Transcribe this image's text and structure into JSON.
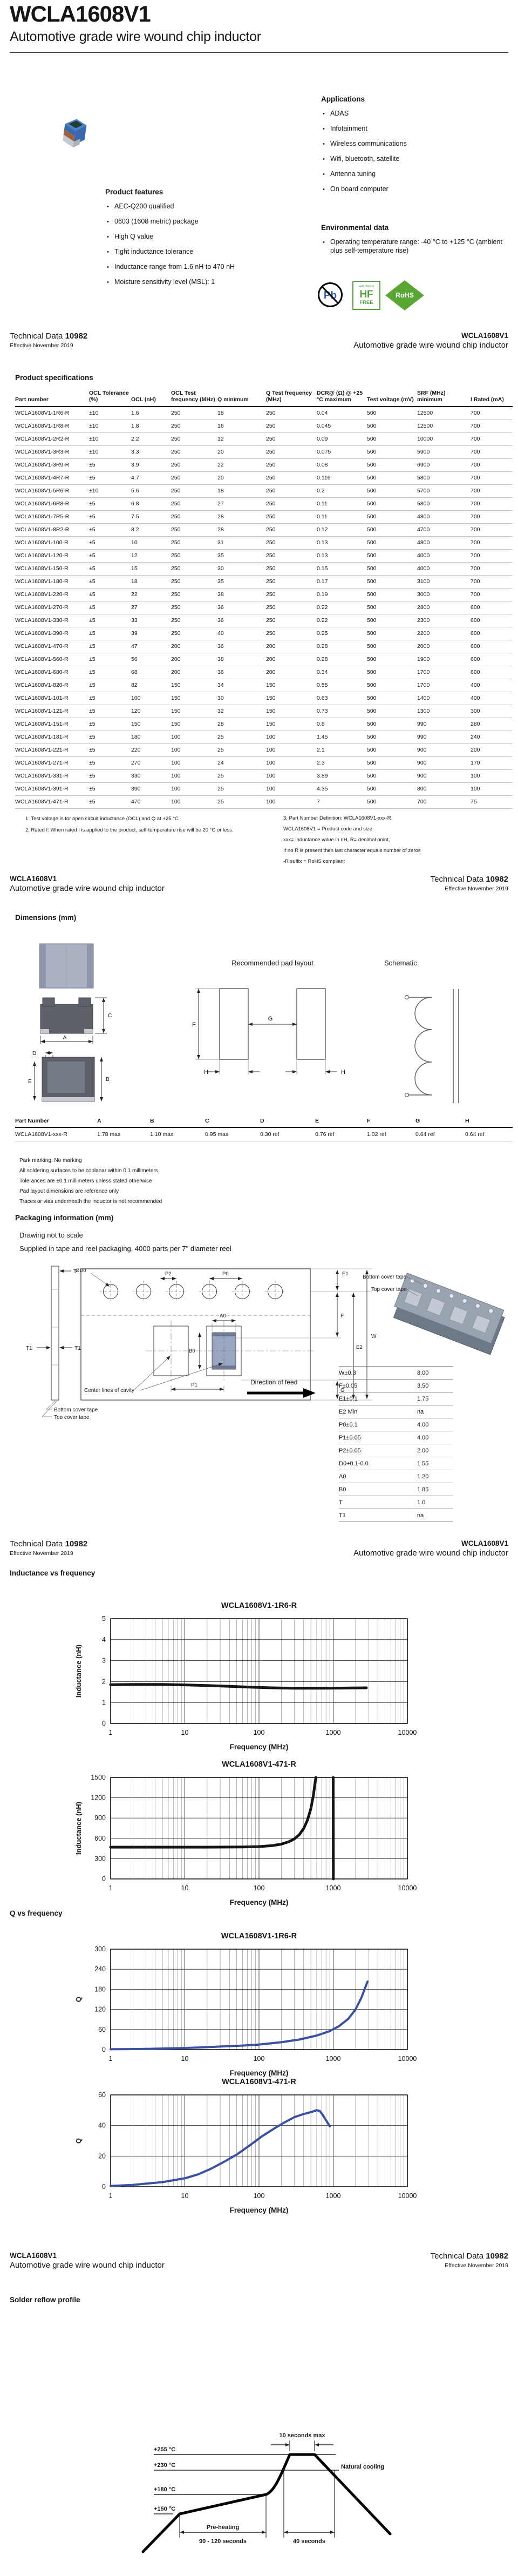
{
  "doc": {
    "title": "WCLA1608V1",
    "subtitle": "Automotive grade wire wound chip inductor",
    "technical_data_label": "Technical Data",
    "technical_data_number": "10982",
    "effective": "Effective November 2019"
  },
  "applications": {
    "heading": "Applications",
    "items": [
      "ADAS",
      "Infotainment",
      "Wireless communications",
      "Wifi, bluetooth, satellite",
      "Antenna tuning",
      "On board computer"
    ]
  },
  "features": {
    "heading": "Product features",
    "items": [
      "AEC-Q200 qualified",
      "0603 (1608 metric) package",
      "High Q value",
      "Tight inductance tolerance",
      "Inductance range from 1.6 nH to 470 nH",
      "Moisture sensitivity level (MSL): 1"
    ]
  },
  "environmental": {
    "heading": "Environmental data",
    "items": [
      "Operating temperature range: -40 °C to +125 °C (ambient plus self-temperature rise)"
    ]
  },
  "logos": {
    "pb": "Pb",
    "hf_line1": "HALOGEN",
    "hf_line2": "HF",
    "hf_line3": "FREE",
    "rohs": "RoHS"
  },
  "specs": {
    "heading": "Product specifications",
    "columns": [
      "Part number",
      "OCL Tolerance (%)",
      "OCL (nH)",
      "OCL Test frequency (MHz)",
      "Q minimum",
      "Q Test frequency (MHz)",
      "DCR@ (Ω) @ +25 °C maximum",
      "Test voltage (mV)",
      "SRF (MHz) minimum",
      "I Rated (mA)"
    ],
    "rows": [
      [
        "WCLA1608V1-1R6-R",
        "±10",
        "1.6",
        "250",
        "18",
        "250",
        "0.04",
        "500",
        "12500",
        "700"
      ],
      [
        "WCLA1608V1-1R8-R",
        "±10",
        "1.8",
        "250",
        "16",
        "250",
        "0.045",
        "500",
        "12500",
        "700"
      ],
      [
        "WCLA1608V1-2R2-R",
        "±10",
        "2.2",
        "250",
        "12",
        "250",
        "0.09",
        "500",
        "10000",
        "700"
      ],
      [
        "WCLA1608V1-3R3-R",
        "±10",
        "3.3",
        "250",
        "20",
        "250",
        "0.075",
        "500",
        "5900",
        "700"
      ],
      [
        "WCLA1608V1-3R9-R",
        "±5",
        "3.9",
        "250",
        "22",
        "250",
        "0.08",
        "500",
        "6900",
        "700"
      ],
      [
        "WCLA1608V1-4R7-R",
        "±5",
        "4.7",
        "250",
        "20",
        "250",
        "0.116",
        "500",
        "5800",
        "700"
      ],
      [
        "WCLA1608V1-5R6-R",
        "±10",
        "5.6",
        "250",
        "18",
        "250",
        "0.2",
        "500",
        "5700",
        "700"
      ],
      [
        "WCLA1608V1-6R8-R",
        "±5",
        "6.8",
        "250",
        "27",
        "250",
        "0.11",
        "500",
        "5800",
        "700"
      ],
      [
        "WCLA1608V1-7R5-R",
        "±5",
        "7.5",
        "250",
        "28",
        "250",
        "0.11",
        "500",
        "4800",
        "700"
      ],
      [
        "WCLA1608V1-8R2-R",
        "±5",
        "8.2",
        "250",
        "28",
        "250",
        "0.12",
        "500",
        "4700",
        "700"
      ],
      [
        "WCLA1608V1-100-R",
        "±5",
        "10",
        "250",
        "31",
        "250",
        "0.13",
        "500",
        "4800",
        "700"
      ],
      [
        "WCLA1608V1-120-R",
        "±5",
        "12",
        "250",
        "35",
        "250",
        "0.13",
        "500",
        "4000",
        "700"
      ],
      [
        "WCLA1608V1-150-R",
        "±5",
        "15",
        "250",
        "30",
        "250",
        "0.15",
        "500",
        "4000",
        "700"
      ],
      [
        "WCLA1608V1-180-R",
        "±5",
        "18",
        "250",
        "35",
        "250",
        "0.17",
        "500",
        "3100",
        "700"
      ],
      [
        "WCLA1608V1-220-R",
        "±5",
        "22",
        "250",
        "38",
        "250",
        "0.19",
        "500",
        "3000",
        "700"
      ],
      [
        "WCLA1608V1-270-R",
        "±5",
        "27",
        "250",
        "36",
        "250",
        "0.22",
        "500",
        "2800",
        "600"
      ],
      [
        "WCLA1608V1-330-R",
        "±5",
        "33",
        "250",
        "36",
        "250",
        "0.22",
        "500",
        "2300",
        "600"
      ],
      [
        "WCLA1608V1-390-R",
        "±5",
        "39",
        "250",
        "40",
        "250",
        "0.25",
        "500",
        "2200",
        "600"
      ],
      [
        "WCLA1608V1-470-R",
        "±5",
        "47",
        "200",
        "36",
        "200",
        "0.28",
        "500",
        "2000",
        "600"
      ],
      [
        "WCLA1608V1-560-R",
        "±5",
        "56",
        "200",
        "38",
        "200",
        "0.28",
        "500",
        "1900",
        "600"
      ],
      [
        "WCLA1608V1-680-R",
        "±5",
        "68",
        "200",
        "36",
        "200",
        "0.34",
        "500",
        "1700",
        "600"
      ],
      [
        "WCLA1608V1-820-R",
        "±5",
        "82",
        "150",
        "34",
        "150",
        "0.55",
        "500",
        "1700",
        "400"
      ],
      [
        "WCLA1608V1-101-R",
        "±5",
        "100",
        "150",
        "30",
        "150",
        "0.63",
        "500",
        "1400",
        "400"
      ],
      [
        "WCLA1608V1-121-R",
        "±5",
        "120",
        "150",
        "32",
        "150",
        "0.73",
        "500",
        "1300",
        "300"
      ],
      [
        "WCLA1608V1-151-R",
        "±5",
        "150",
        "150",
        "28",
        "150",
        "0.8",
        "500",
        "990",
        "280"
      ],
      [
        "WCLA1608V1-181-R",
        "±5",
        "180",
        "100",
        "25",
        "100",
        "1.45",
        "500",
        "990",
        "240"
      ],
      [
        "WCLA1608V1-221-R",
        "±5",
        "220",
        "100",
        "25",
        "100",
        "2.1",
        "500",
        "900",
        "200"
      ],
      [
        "WCLA1608V1-271-R",
        "±5",
        "270",
        "100",
        "24",
        "100",
        "2.3",
        "500",
        "900",
        "170"
      ],
      [
        "WCLA1608V1-331-R",
        "±5",
        "330",
        "100",
        "25",
        "100",
        "3.89",
        "500",
        "900",
        "100"
      ],
      [
        "WCLA1608V1-391-R",
        "±5",
        "390",
        "100",
        "25",
        "100",
        "4.35",
        "500",
        "800",
        "100"
      ],
      [
        "WCLA1608V1-471-R",
        "±5",
        "470",
        "100",
        "25",
        "100",
        "7",
        "500",
        "700",
        "75"
      ]
    ],
    "footnotes_left": [
      "1. Test voltage is for open circuit inductance (OCL) and Q at +25 °C",
      "2. Rated I: When rated I is applied to the product, self-temperature rise will be 20 °C or less."
    ],
    "footnotes_right": [
      "3. Part Number Definition: WCLA1608V1-xxx-R",
      "WCLA1608V1 = Product code and size",
      "xxx= inductance value in nH, R= decimal point,",
      "If no R is present then last character equals number of zeros",
      "-R suffix = RoHS compliant"
    ]
  },
  "dimensions": {
    "heading": "Dimensions (mm)",
    "pad_layout_title": "Recommended pad layout",
    "schematic_title": "Schematic",
    "columns": [
      "Part Number",
      "A",
      "B",
      "C",
      "D",
      "E",
      "F",
      "G",
      "H"
    ],
    "row": [
      "WCLA1608V1-xxx-R",
      "1.78 max",
      "1.10 max",
      "0.95 max",
      "0.30 ref",
      "0.76 ref",
      "1.02 ref",
      "0.64 ref",
      "0.64 ref"
    ],
    "labels": {
      "a": "A",
      "b": "B",
      "c": "C",
      "d": "D",
      "e": "E",
      "f": "F",
      "g": "G",
      "h": "H"
    },
    "notes": [
      "Park marking: No marking",
      "All soldering surfaces to be coplanar within 0.1 millimeters",
      "Tolerances are ±0.1 millimeters unless stated otherwise",
      "Pad layout dimensions are reference only",
      "Traces or vias underneath the inductor is not recommended"
    ]
  },
  "packaging": {
    "heading": "Packaging information (mm)",
    "note_scale": "Drawing not to scale",
    "note_supply": "Supplied in tape and reel packaging, 4000 parts per 7\" diameter reel",
    "labels": {
      "t": "T",
      "t1": "T1",
      "d0": "ØD0",
      "p2": "P2",
      "p0": "P0",
      "e1": "E1",
      "w": "W",
      "e2": "E2",
      "f": "F",
      "g": "G",
      "a0": "A0",
      "b0": "B0",
      "p1": "P1",
      "center_lines": "Center lines of cavity",
      "bottom_cover": "Bottom cover tape",
      "top_cover": "Top cover tape",
      "direction": "Direction of feed"
    },
    "table": [
      [
        "W±0.3",
        "8.00"
      ],
      [
        "F±0.05",
        "3.50"
      ],
      [
        "E1±0.1",
        "1.75"
      ],
      [
        "E2 Min",
        "na"
      ],
      [
        "P0±0.1",
        "4.00"
      ],
      [
        "P1±0.05",
        "4.00"
      ],
      [
        "P2±0.05",
        "2.00"
      ],
      [
        "D0+0.1-0.0",
        "1.55"
      ],
      [
        "A0",
        "1.20"
      ],
      [
        "B0",
        "1.85"
      ],
      [
        "T",
        "1.0"
      ],
      [
        "T1",
        "na"
      ]
    ]
  },
  "sections": {
    "inductance": "Inductance vs frequency",
    "q": "Q vs frequency",
    "reflow": "Solder reflow profile"
  },
  "chart_data": [
    {
      "id": "inductance-1r6",
      "type": "line",
      "title": "WCLA1608V1-1R6-R",
      "xlabel": "Frequency (MHz)",
      "ylabel": "Inductance (nH)",
      "x_scale": "log",
      "x_ticks": [
        1,
        10,
        100,
        1000,
        10000
      ],
      "ylim": [
        0,
        5
      ],
      "y_ticks": [
        0,
        1,
        2,
        3,
        4,
        5
      ],
      "color": "#141414",
      "stroke_width": 5,
      "grid": true,
      "legend": "none",
      "series": [
        {
          "name": "inductance",
          "points": [
            [
              1,
              1.85
            ],
            [
              2,
              1.86
            ],
            [
              5,
              1.86
            ],
            [
              10,
              1.84
            ],
            [
              20,
              1.81
            ],
            [
              40,
              1.77
            ],
            [
              80,
              1.73
            ],
            [
              150,
              1.7
            ],
            [
              300,
              1.68
            ],
            [
              700,
              1.68
            ],
            [
              1500,
              1.69
            ],
            [
              2800,
              1.7
            ]
          ]
        }
      ]
    },
    {
      "id": "inductance-471",
      "type": "line",
      "title": "WCLA1608V1-471-R",
      "xlabel": "Frequency (MHz)",
      "ylabel": "Inductance (nH)",
      "x_scale": "log",
      "x_ticks": [
        1,
        10,
        100,
        1000,
        10000
      ],
      "ylim": [
        0,
        1500
      ],
      "y_ticks": [
        0,
        300,
        600,
        900,
        1200,
        1500
      ],
      "color": "#141414",
      "stroke_width": 5,
      "grid": true,
      "legend": "none",
      "series": [
        {
          "name": "inductance",
          "points": [
            [
              1,
              470
            ],
            [
              5,
              470
            ],
            [
              20,
              470
            ],
            [
              60,
              472
            ],
            [
              100,
              478
            ],
            [
              150,
              492
            ],
            [
              200,
              515
            ],
            [
              250,
              548
            ],
            [
              300,
              592
            ],
            [
              350,
              655
            ],
            [
              400,
              745
            ],
            [
              450,
              870
            ],
            [
              500,
              1040
            ],
            [
              540,
              1230
            ],
            [
              570,
              1420
            ],
            [
              585,
              1500
            ]
          ]
        },
        {
          "name": "post-resonance",
          "points": [
            [
              1000,
              1500
            ],
            [
              1005,
              0
            ]
          ]
        }
      ]
    },
    {
      "id": "q-1r6",
      "type": "line",
      "title": "WCLA1608V1-1R6-R",
      "xlabel": "Frequency (MHz)",
      "ylabel": "Q",
      "x_scale": "log",
      "x_ticks": [
        1,
        10,
        100,
        1000,
        10000
      ],
      "ylim": [
        0,
        300
      ],
      "y_ticks": [
        0,
        60,
        120,
        180,
        240,
        300
      ],
      "color": "#3a51a3",
      "stroke_width": 4,
      "grid": true,
      "legend": "none",
      "series": [
        {
          "name": "q",
          "points": [
            [
              1,
              1
            ],
            [
              3,
              2
            ],
            [
              8,
              4
            ],
            [
              15,
              6
            ],
            [
              30,
              9
            ],
            [
              60,
              12
            ],
            [
              100,
              15
            ],
            [
              200,
              22
            ],
            [
              350,
              30
            ],
            [
              600,
              42
            ],
            [
              900,
              55
            ],
            [
              1200,
              70
            ],
            [
              1600,
              92
            ],
            [
              2000,
              120
            ],
            [
              2400,
              155
            ],
            [
              2700,
              185
            ],
            [
              2900,
              203
            ]
          ]
        }
      ]
    },
    {
      "id": "q-471",
      "type": "line",
      "title": "WCLA1608V1-471-R",
      "xlabel": "Frequency (MHz)",
      "ylabel": "Q",
      "x_scale": "log",
      "x_ticks": [
        1,
        10,
        100,
        1000,
        10000
      ],
      "ylim": [
        0,
        60
      ],
      "y_ticks": [
        0,
        20,
        40,
        60
      ],
      "color": "#3a51a3",
      "stroke_width": 4,
      "grid": true,
      "legend": "none",
      "series": [
        {
          "name": "q",
          "points": [
            [
              1,
              0.5
            ],
            [
              2,
              1.2
            ],
            [
              5,
              3
            ],
            [
              10,
              5.5
            ],
            [
              15,
              8
            ],
            [
              22,
              11.5
            ],
            [
              33,
              16
            ],
            [
              50,
              21
            ],
            [
              75,
              27
            ],
            [
              110,
              33
            ],
            [
              160,
              38
            ],
            [
              220,
              42
            ],
            [
              300,
              45.5
            ],
            [
              400,
              47.5
            ],
            [
              520,
              49
            ],
            [
              600,
              50
            ],
            [
              660,
              49.5
            ],
            [
              720,
              47
            ],
            [
              800,
              43.5
            ],
            [
              900,
              39.5
            ]
          ]
        }
      ]
    }
  ],
  "reflow": {
    "temps": [
      "+255 °C",
      "+230 °C",
      "+180 °C",
      "+150 °C"
    ],
    "ten_sec": "10 seconds max",
    "natural": "Natural cooling",
    "preheat": "Pre-heating",
    "preheat_time": "90 - 120 seconds",
    "forty": "40 seconds"
  }
}
